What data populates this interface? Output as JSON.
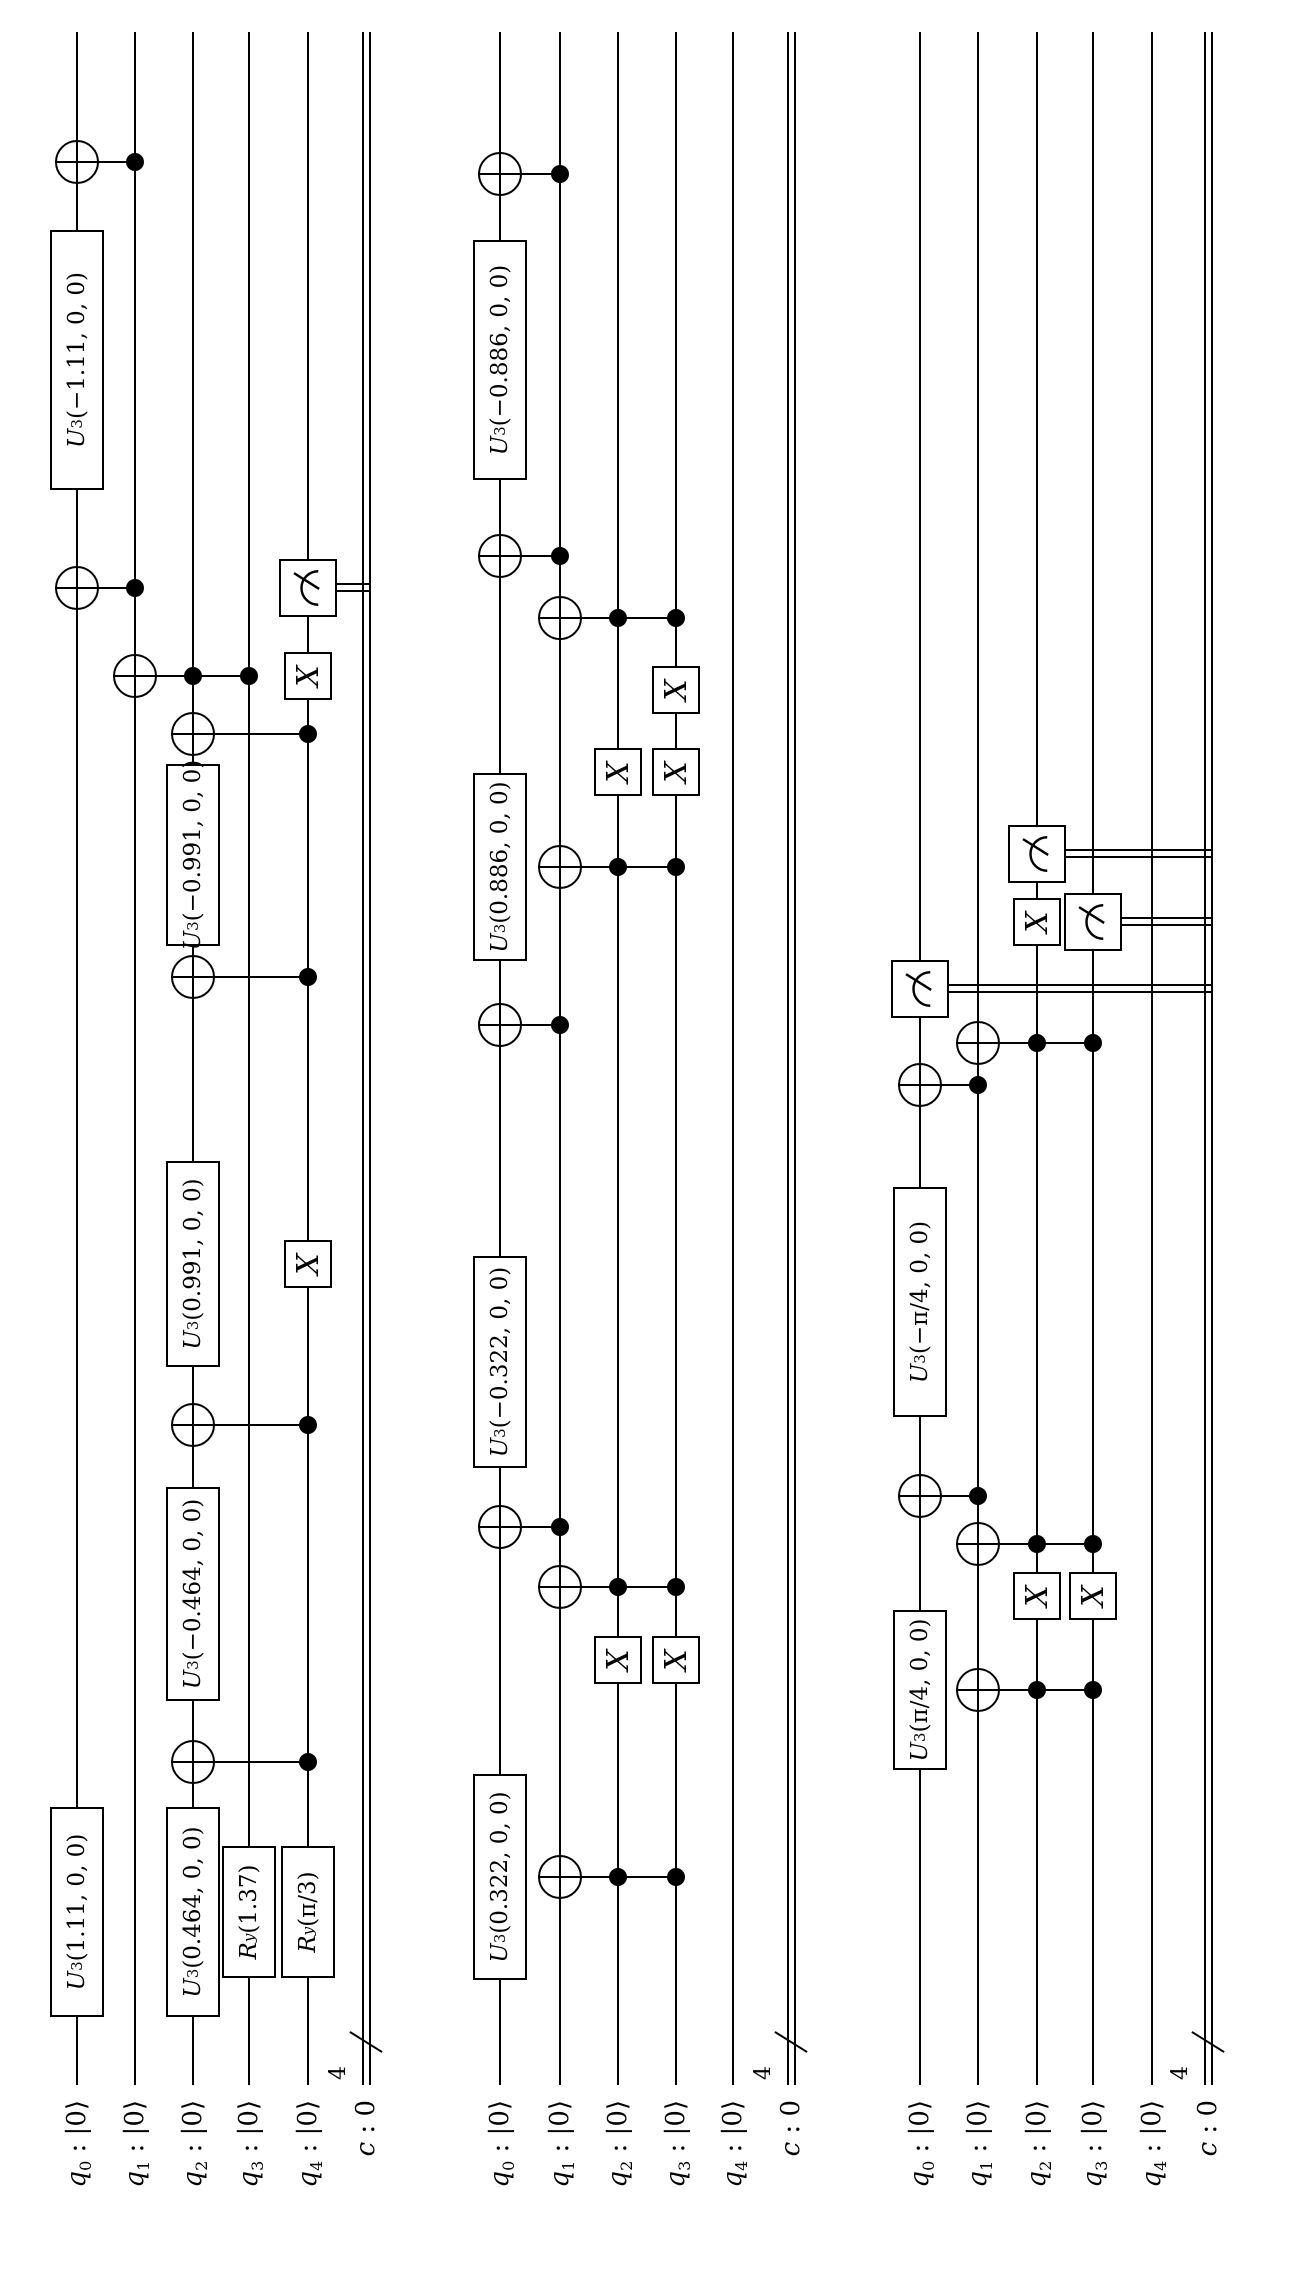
{
  "figure": {
    "type": "quantum-circuit-diagram",
    "orientation": "rotated-90-ccw",
    "background": "#ffffff",
    "ink": "#000000",
    "num_circuits": 3,
    "qubits_per_circuit": 5,
    "classical_bits": "4"
  },
  "shared": {
    "wire_start": 189,
    "wire_end": 2242,
    "label_left": -6,
    "bundle": {
      "x": 232,
      "size": "4"
    },
    "qubit_labels": [
      {
        "main": "q",
        "sub": "0",
        "rest": " : |0⟩"
      },
      {
        "main": "q",
        "sub": "1",
        "rest": " : |0⟩"
      },
      {
        "main": "q",
        "sub": "2",
        "rest": " : |0⟩"
      },
      {
        "main": "q",
        "sub": "3",
        "rest": " : |0⟩"
      },
      {
        "main": "q",
        "sub": "4",
        "rest": " : |0⟩"
      }
    ],
    "classical_label": {
      "main": "c",
      "sub": "",
      "rest": " : 0"
    }
  },
  "circuits": [
    {
      "id": "circuit-1",
      "rows": {
        "q": [
          77,
          135,
          193,
          249,
          308
        ],
        "c": 366
      },
      "columns": [
        {
          "x": 362,
          "gates": [
            {
              "t": "u",
              "q": 0,
              "m": "U",
              "s": "3",
              "args": "(1.11, 0, 0)",
              "len": 210
            },
            {
              "t": "u",
              "q": 2,
              "m": "U",
              "s": "3",
              "args": "(0.464, 0, 0)",
              "len": 210
            },
            {
              "t": "u",
              "q": 3,
              "m": "R",
              "s": "y",
              "args": "(1.37)",
              "len": 132
            },
            {
              "t": "u",
              "q": 4,
              "m": "R",
              "s": "y",
              "args": "(π/3)",
              "len": 132
            }
          ]
        },
        {
          "x": 512,
          "gates": [
            {
              "t": "cx",
              "target": 2,
              "ctrls": [
                4
              ]
            }
          ]
        },
        {
          "x": 680,
          "gates": [
            {
              "t": "u",
              "q": 2,
              "m": "U",
              "s": "3",
              "args": "(−0.464, 0, 0)",
              "len": 214
            }
          ]
        },
        {
          "x": 849,
          "gates": [
            {
              "t": "cx",
              "target": 2,
              "ctrls": [
                4
              ]
            }
          ]
        },
        {
          "x": 1010,
          "gates": [
            {
              "t": "u",
              "q": 2,
              "m": "U",
              "s": "3",
              "args": "(0.991, 0, 0)",
              "len": 206
            },
            {
              "t": "x",
              "q": 4
            }
          ]
        },
        {
          "x": 1297,
          "gates": [
            {
              "t": "cx",
              "target": 2,
              "ctrls": [
                4
              ]
            }
          ]
        },
        {
          "x": 1419,
          "gates": [
            {
              "t": "u",
              "q": 2,
              "m": "U",
              "s": "3",
              "args": "(−0.991, 0, 0)",
              "len": 182
            }
          ]
        },
        {
          "x": 1540,
          "gates": [
            {
              "t": "cx",
              "target": 2,
              "ctrls": [
                4
              ]
            }
          ]
        },
        {
          "x": 1598,
          "gates": [
            {
              "t": "cx",
              "target": 1,
              "ctrls": [
                2,
                3
              ]
            },
            {
              "t": "x",
              "q": 4
            }
          ]
        },
        {
          "x": 1686,
          "gates": [
            {
              "t": "cx",
              "target": 0,
              "ctrls": [
                1
              ]
            },
            {
              "t": "meas",
              "q": 4
            }
          ]
        },
        {
          "x": 1914,
          "gates": [
            {
              "t": "u",
              "q": 0,
              "m": "U",
              "s": "3",
              "args": "(−1.11, 0, 0)",
              "len": 260
            }
          ]
        },
        {
          "x": 2112,
          "gates": [
            {
              "t": "cx",
              "target": 0,
              "ctrls": [
                1
              ]
            }
          ]
        }
      ]
    },
    {
      "id": "circuit-2",
      "rows": {
        "q": [
          500,
          560,
          618,
          676,
          733
        ],
        "c": 791
      },
      "columns": [
        {
          "x": 397,
          "gates": [
            {
              "t": "u",
              "q": 0,
              "m": "U",
              "s": "3",
              "args": "(0.322, 0, 0)",
              "len": 206
            },
            {
              "t": "cx",
              "target": 1,
              "ctrls": [
                2,
                3
              ]
            }
          ]
        },
        {
          "x": 614,
          "gates": [
            {
              "t": "x",
              "q": 2
            },
            {
              "t": "x",
              "q": 3
            }
          ]
        },
        {
          "x": 687,
          "gates": [
            {
              "t": "cx",
              "target": 1,
              "ctrls": [
                2,
                3
              ]
            }
          ]
        },
        {
          "x": 747,
          "gates": [
            {
              "t": "cx",
              "target": 0,
              "ctrls": [
                1
              ]
            }
          ]
        },
        {
          "x": 912,
          "gates": [
            {
              "t": "u",
              "q": 0,
              "m": "U",
              "s": "3",
              "args": "(−0.322, 0, 0)",
              "len": 212
            }
          ]
        },
        {
          "x": 1249,
          "gates": [
            {
              "t": "cx",
              "target": 0,
              "ctrls": [
                1
              ]
            }
          ]
        },
        {
          "x": 1407,
          "gates": [
            {
              "t": "u",
              "q": 0,
              "m": "U",
              "s": "3",
              "args": "(0.886, 0, 0)",
              "len": 188
            },
            {
              "t": "cx",
              "target": 1,
              "ctrls": [
                2,
                3
              ]
            }
          ]
        },
        {
          "x": 1502,
          "gates": [
            {
              "t": "x",
              "q": 2
            },
            {
              "t": "x",
              "q": 3
            }
          ]
        },
        {
          "x": 1584,
          "gates": [
            {
              "t": "x",
              "q": 3
            }
          ]
        },
        {
          "x": 1656,
          "gates": [
            {
              "t": "cx",
              "target": 1,
              "ctrls": [
                2,
                3
              ]
            }
          ]
        },
        {
          "x": 1718,
          "gates": [
            {
              "t": "cx",
              "target": 0,
              "ctrls": [
                1
              ]
            }
          ]
        },
        {
          "x": 1914,
          "gates": [
            {
              "t": "u",
              "q": 0,
              "m": "U",
              "s": "3",
              "args": "(−0.886, 0, 0)",
              "len": 240
            }
          ]
        },
        {
          "x": 2100,
          "gates": [
            {
              "t": "cx",
              "target": 0,
              "ctrls": [
                1
              ]
            }
          ]
        }
      ]
    },
    {
      "id": "circuit-3",
      "rows": {
        "q": [
          920,
          978,
          1037,
          1093,
          1152
        ],
        "c": 1208
      },
      "columns": [
        {
          "x": 584,
          "gates": [
            {
              "t": "u",
              "q": 0,
              "m": "U",
              "s": "3",
              "args": "(π/4, 0, 0)",
              "len": 160
            },
            {
              "t": "cx",
              "target": 1,
              "ctrls": [
                2,
                3
              ]
            }
          ]
        },
        {
          "x": 678,
          "gates": [
            {
              "t": "x",
              "q": 2
            },
            {
              "t": "x",
              "q": 3
            }
          ]
        },
        {
          "x": 730,
          "gates": [
            {
              "t": "cx",
              "target": 1,
              "ctrls": [
                2,
                3
              ]
            }
          ]
        },
        {
          "x": 778,
          "gates": [
            {
              "t": "cx",
              "target": 0,
              "ctrls": [
                1
              ]
            }
          ]
        },
        {
          "x": 972,
          "gates": [
            {
              "t": "u",
              "q": 0,
              "m": "U",
              "s": "3",
              "args": "(−π/4, 0, 0)",
              "len": 230
            }
          ]
        },
        {
          "x": 1189,
          "gates": [
            {
              "t": "cx",
              "target": 0,
              "ctrls": [
                1
              ]
            }
          ]
        },
        {
          "x": 1231,
          "gates": [
            {
              "t": "cx",
              "target": 1,
              "ctrls": [
                2,
                3
              ]
            }
          ]
        },
        {
          "x": 1285,
          "gates": [
            {
              "t": "meas",
              "q": 0
            }
          ]
        },
        {
          "x": 1352,
          "gates": [
            {
              "t": "x",
              "q": 2
            },
            {
              "t": "meas",
              "q": 3
            }
          ]
        },
        {
          "x": 1420,
          "gates": [
            {
              "t": "meas",
              "q": 2
            }
          ]
        }
      ]
    }
  ]
}
